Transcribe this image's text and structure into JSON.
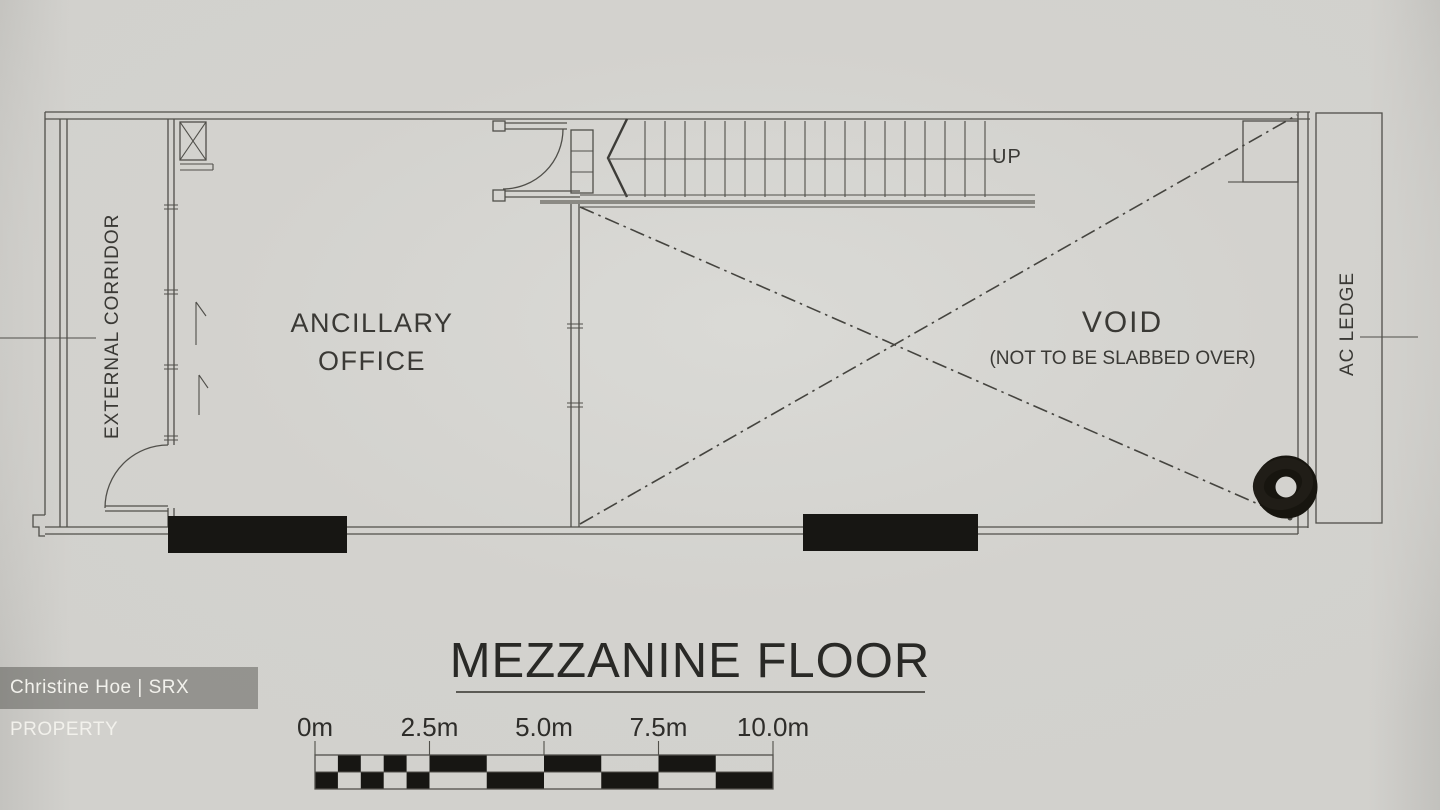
{
  "plan_labels": {
    "external_corridor": "EXTERNAL CORRIDOR",
    "ancillary_office_line1": "ANCILLARY",
    "ancillary_office_line2": "OFFICE",
    "up": "UP",
    "void": "VOID",
    "void_note": "(NOT TO BE SLABBED OVER)",
    "ac_ledge": "AC LEDGE"
  },
  "title": "MEZZANINE FLOOR",
  "scale_bar": {
    "labels": [
      "0m",
      "2.5m",
      "5.0m",
      "7.5m",
      "10.0m"
    ],
    "marks_m": [
      0,
      2.5,
      5,
      7.5,
      10
    ],
    "total_m": 10,
    "small_section": {
      "to_m": 2.5,
      "step_m": 0.5,
      "top_first_black": false
    },
    "large_section": {
      "from_m": 2.5,
      "step_m": 1.25,
      "top_first_black": true
    }
  },
  "watermark": "Christine Hoe | SRX PROPERTY",
  "colors": {
    "paper": "#d2d1cd",
    "line": "#504f4a",
    "ink": "#3a3935",
    "black_fill": "#171613"
  }
}
